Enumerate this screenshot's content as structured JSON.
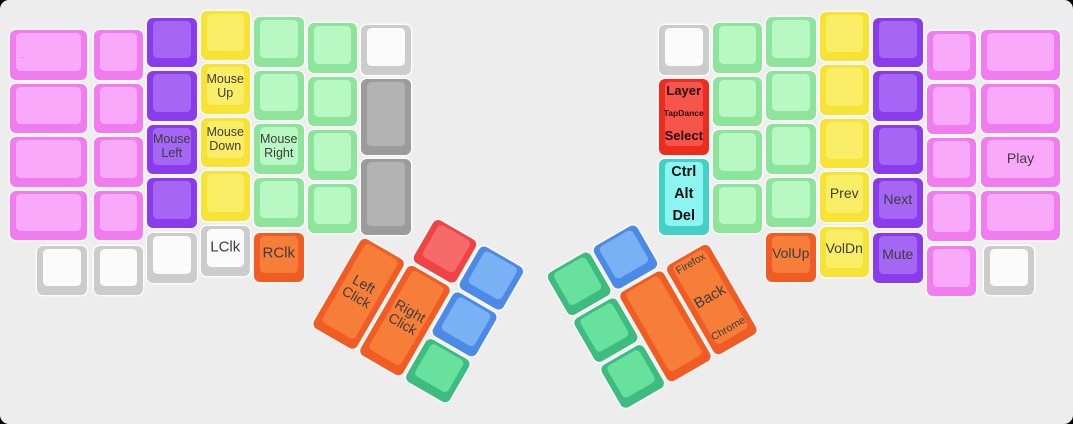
{
  "canvas": {
    "width": 1073,
    "height": 424,
    "background": "#ededed",
    "outside_background": "#000000",
    "key_outline": "rgba(255,255,255,0.75)"
  },
  "palette": {
    "pink": {
      "base": "#f07cf0",
      "top": "#f9a9f9"
    },
    "purple": {
      "base": "#8a3bee",
      "top": "#a466f3"
    },
    "yellow": {
      "base": "#f6e336",
      "top": "#faee67"
    },
    "green": {
      "base": "#8ce59b",
      "top": "#b8f8c2"
    },
    "white": {
      "base": "#cccccc",
      "top": "#fbfbfb"
    },
    "gray": {
      "base": "#9c9c9c",
      "top": "#b3b3b3"
    },
    "red": {
      "base": "#ee2c1e",
      "top": "#f5554a"
    },
    "cyan": {
      "base": "#43d0c6",
      "top": "#8cf5f2"
    },
    "orange": {
      "base": "#f15c25",
      "top": "#f67e39"
    },
    "blue": {
      "base": "#4b8be7",
      "top": "#79b1f4"
    },
    "emerald": {
      "base": "#3ebc7f",
      "top": "#68e19e"
    },
    "thumbred": {
      "base": "#f04343",
      "top": "#f66a6a"
    }
  },
  "groups": {
    "main": {
      "rotation_deg": 0,
      "origin_x": 0,
      "origin_y": 0
    },
    "thumb_left": {
      "rotation_deg": 30,
      "origin_x": 362,
      "origin_y": 234
    },
    "thumb_right": {
      "rotation_deg": -30,
      "origin_x": 708,
      "origin_y": 240
    }
  },
  "key_schema": [
    "group",
    "x",
    "y",
    "w",
    "h",
    "color",
    "name",
    "labels"
  ],
  "keys": [
    [
      "main",
      10,
      30,
      77,
      49.5,
      "pink",
      "key-left-c1-r1",
      [
        {
          "t": ".",
          "pos": "left",
          "size": 7,
          "color": "#555555"
        }
      ]
    ],
    [
      "main",
      10,
      83.5,
      77,
      49.5,
      "pink",
      "key-left-c1-r2"
    ],
    [
      "main",
      10,
      137,
      77,
      49.5,
      "pink",
      "key-left-c1-r3"
    ],
    [
      "main",
      10,
      190.5,
      77,
      49.5,
      "pink",
      "key-left-c1-r4"
    ],
    [
      "main",
      93.5,
      30,
      49.5,
      49.5,
      "pink",
      "key-left-c2-r1"
    ],
    [
      "main",
      93.5,
      83.5,
      49.5,
      49.5,
      "pink",
      "key-left-c2-r2"
    ],
    [
      "main",
      93.5,
      137,
      49.5,
      49.5,
      "pink",
      "key-left-c2-r3"
    ],
    [
      "main",
      93.5,
      190.5,
      49.5,
      49.5,
      "pink",
      "key-left-c2-r4"
    ],
    [
      "main",
      147,
      17.5,
      49.5,
      49.5,
      "purple",
      "key-left-c3-r1"
    ],
    [
      "main",
      147,
      71,
      49.5,
      49.5,
      "purple",
      "key-left-c3-r2"
    ],
    [
      "main",
      147,
      124.5,
      49.5,
      49.5,
      "purple",
      "key-mouse-left",
      [
        {
          "t": "Mouse Left",
          "pos": "center",
          "size": 12.5
        }
      ]
    ],
    [
      "main",
      147,
      178,
      49.5,
      49.5,
      "purple",
      "key-left-c3-r4"
    ],
    [
      "main",
      200.5,
      10.5,
      49.5,
      49.5,
      "yellow",
      "key-left-c4-r1"
    ],
    [
      "main",
      200.5,
      64,
      49.5,
      49.5,
      "yellow",
      "key-mouse-up",
      [
        {
          "t": "Mouse Up",
          "pos": "center",
          "size": 12.5
        }
      ]
    ],
    [
      "main",
      200.5,
      117.5,
      49.5,
      49.5,
      "yellow",
      "key-mouse-down",
      [
        {
          "t": "Mouse Down",
          "pos": "center",
          "size": 12.5
        }
      ]
    ],
    [
      "main",
      200.5,
      171,
      49.5,
      49.5,
      "yellow",
      "key-left-c4-r4"
    ],
    [
      "main",
      254,
      17,
      49.5,
      49.5,
      "green",
      "key-left-c5-r1"
    ],
    [
      "main",
      254,
      70.5,
      49.5,
      49.5,
      "green",
      "key-left-c5-r2"
    ],
    [
      "main",
      254,
      124,
      49.5,
      49.5,
      "green",
      "key-mouse-right",
      [
        {
          "t": "Mouse Right",
          "pos": "center",
          "size": 12.5
        }
      ]
    ],
    [
      "main",
      254,
      177.5,
      49.5,
      49.5,
      "green",
      "key-left-c5-r4"
    ],
    [
      "main",
      307.5,
      23,
      49.5,
      49.5,
      "green",
      "key-left-c6-r1"
    ],
    [
      "main",
      307.5,
      76.5,
      49.5,
      49.5,
      "green",
      "key-left-c6-r2"
    ],
    [
      "main",
      307.5,
      130,
      49.5,
      49.5,
      "green",
      "key-left-c6-r3"
    ],
    [
      "main",
      307.5,
      183.5,
      49.5,
      49.5,
      "green",
      "key-left-c6-r4"
    ],
    [
      "main",
      361,
      25,
      49.5,
      49.5,
      "white",
      "key-left-c7-r1"
    ],
    [
      "main",
      361,
      78.5,
      49.5,
      76.3,
      "gray",
      "key-left-c7-tall1"
    ],
    [
      "main",
      361,
      158.8,
      49.5,
      76.3,
      "gray",
      "key-left-c7-tall2"
    ],
    [
      "main",
      37,
      245.5,
      49.5,
      49.5,
      "white",
      "key-left-bottom-1"
    ],
    [
      "main",
      93.5,
      245.5,
      49.5,
      49.5,
      "white",
      "key-left-bottom-2"
    ],
    [
      "main",
      147,
      233,
      49.5,
      49.5,
      "white",
      "key-left-bottom-3"
    ],
    [
      "main",
      200.5,
      226,
      49.5,
      49.5,
      "white",
      "key-lclk",
      [
        {
          "t": "LClk",
          "pos": "center",
          "size": 15
        }
      ]
    ],
    [
      "main",
      254,
      232.5,
      49.5,
      49.5,
      "orange",
      "key-rclk",
      [
        {
          "t": "RClk",
          "pos": "center",
          "size": 15
        }
      ]
    ],
    [
      "thumb_left",
      55.5,
      -51.5,
      49.5,
      49.5,
      "thumbred",
      "key-lthumb-red"
    ],
    [
      "thumb_left",
      109,
      -51.5,
      49.5,
      49.5,
      "blue",
      "key-lthumb-blue1"
    ],
    [
      "thumb_left",
      2,
      2,
      49.5,
      103,
      "orange",
      "key-left-click",
      [
        {
          "t": "Left Click",
          "pos": "center",
          "size": 14
        }
      ]
    ],
    [
      "thumb_left",
      55.5,
      2,
      49.5,
      103,
      "orange",
      "key-right-click",
      [
        {
          "t": "Right Click",
          "pos": "center",
          "size": 14
        }
      ]
    ],
    [
      "thumb_left",
      109,
      2,
      49.5,
      49.5,
      "blue",
      "key-lthumb-blue2"
    ],
    [
      "thumb_left",
      109,
      55.5,
      49.5,
      49.5,
      "emerald",
      "key-lthumb-green"
    ],
    [
      "main",
      659,
      25,
      49.5,
      49.5,
      "white",
      "key-right-c1-r1"
    ],
    [
      "main",
      659,
      78.5,
      49.5,
      76.3,
      "red",
      "key-layer-tapdance-select",
      [
        {
          "t": "Layer",
          "pos": "top",
          "size": 13,
          "bold": true,
          "color": "#2d0b08"
        },
        {
          "t": "TapDance",
          "pos": "mid",
          "size": 8.5,
          "bold": true,
          "color": "#2d0b08"
        },
        {
          "t": "Select",
          "pos": "bottom",
          "size": 13,
          "bold": true,
          "color": "#2d0b08"
        }
      ]
    ],
    [
      "main",
      659,
      158.8,
      49.5,
      76.3,
      "cyan",
      "key-ctrl-alt-del",
      [
        {
          "t": "Ctrl",
          "pos": "top",
          "size": 14.5,
          "bold": true,
          "color": "#101010"
        },
        {
          "t": "Alt",
          "pos": "mid",
          "size": 14.5,
          "bold": true,
          "color": "#101010"
        },
        {
          "t": "Del",
          "pos": "bottom",
          "size": 14.5,
          "bold": true,
          "color": "#101010"
        }
      ]
    ],
    [
      "main",
      712.5,
      23,
      49.5,
      49.5,
      "green",
      "key-right-c2-r1"
    ],
    [
      "main",
      712.5,
      76.5,
      49.5,
      49.5,
      "green",
      "key-right-c2-r2"
    ],
    [
      "main",
      712.5,
      130,
      49.5,
      49.5,
      "green",
      "key-right-c2-r3"
    ],
    [
      "main",
      712.5,
      183.5,
      49.5,
      49.5,
      "green",
      "key-right-c2-r4"
    ],
    [
      "main",
      766,
      17,
      49.5,
      49.5,
      "green",
      "key-right-c3-r1"
    ],
    [
      "main",
      766,
      70.5,
      49.5,
      49.5,
      "green",
      "key-right-c3-r2"
    ],
    [
      "main",
      766,
      124,
      49.5,
      49.5,
      "green",
      "key-right-c3-r3"
    ],
    [
      "main",
      766,
      177.5,
      49.5,
      49.5,
      "green",
      "key-right-c3-r4"
    ],
    [
      "main",
      766,
      232.5,
      49.5,
      49.5,
      "orange",
      "key-volup",
      [
        {
          "t": "VolUp",
          "pos": "center",
          "size": 14
        }
      ]
    ],
    [
      "main",
      819.5,
      11.5,
      49.5,
      49.5,
      "yellow",
      "key-right-c4-r1"
    ],
    [
      "main",
      819.5,
      65,
      49.5,
      49.5,
      "yellow",
      "key-right-c4-r2"
    ],
    [
      "main",
      819.5,
      118.5,
      49.5,
      49.5,
      "yellow",
      "key-right-c4-r3"
    ],
    [
      "main",
      819.5,
      172,
      49.5,
      49.5,
      "yellow",
      "key-prev",
      [
        {
          "t": "Prev",
          "pos": "center",
          "size": 14
        }
      ]
    ],
    [
      "main",
      819.5,
      227,
      49.5,
      49.5,
      "yellow",
      "key-voldn",
      [
        {
          "t": "VolDn",
          "pos": "center",
          "size": 14
        }
      ]
    ],
    [
      "main",
      873,
      17.5,
      49.5,
      49.5,
      "purple",
      "key-right-c5-r1"
    ],
    [
      "main",
      873,
      71,
      49.5,
      49.5,
      "purple",
      "key-right-c5-r2"
    ],
    [
      "main",
      873,
      124.5,
      49.5,
      49.5,
      "purple",
      "key-right-c5-r3"
    ],
    [
      "main",
      873,
      178,
      49.5,
      49.5,
      "purple",
      "key-next",
      [
        {
          "t": "Next",
          "pos": "center",
          "size": 14
        }
      ]
    ],
    [
      "main",
      873,
      233,
      49.5,
      49.5,
      "purple",
      "key-mute",
      [
        {
          "t": "Mute",
          "pos": "center",
          "size": 14
        }
      ]
    ],
    [
      "main",
      926.5,
      30.5,
      49.5,
      49.5,
      "pink",
      "key-right-c6-r1"
    ],
    [
      "main",
      926.5,
      84,
      49.5,
      49.5,
      "pink",
      "key-right-c6-r2"
    ],
    [
      "main",
      926.5,
      137.5,
      49.5,
      49.5,
      "pink",
      "key-right-c6-r3"
    ],
    [
      "main",
      926.5,
      191,
      49.5,
      49.5,
      "pink",
      "key-right-c6-r4"
    ],
    [
      "main",
      926.5,
      246,
      49.5,
      49.5,
      "pink",
      "key-right-bottom-pink"
    ],
    [
      "main",
      981,
      30,
      79,
      49.5,
      "pink",
      "key-right-c7-r1"
    ],
    [
      "main",
      981,
      83.5,
      79,
      49.5,
      "pink",
      "key-right-c7-r2"
    ],
    [
      "main",
      981,
      137,
      79,
      49.5,
      "pink",
      "key-play",
      [
        {
          "t": "Play",
          "pos": "center",
          "size": 14
        }
      ]
    ],
    [
      "main",
      981,
      190.5,
      79,
      49.5,
      "pink",
      "key-right-c7-r4"
    ],
    [
      "main",
      984,
      245.5,
      49.5,
      49.5,
      "white",
      "key-right-bottom-white"
    ],
    [
      "thumb_right",
      -158.5,
      -51.5,
      49.5,
      49.5,
      "emerald",
      "key-rthumb-green1"
    ],
    [
      "thumb_right",
      -105,
      -51.5,
      49.5,
      49.5,
      "blue",
      "key-rthumb-blue"
    ],
    [
      "thumb_right",
      -158.5,
      2,
      49.5,
      49.5,
      "emerald",
      "key-rthumb-green2"
    ],
    [
      "thumb_right",
      -158.5,
      55.5,
      49.5,
      49.5,
      "emerald",
      "key-rthumb-green3"
    ],
    [
      "thumb_right",
      -105,
      2,
      49.5,
      103,
      "orange",
      "key-rthumb-blank"
    ],
    [
      "thumb_right",
      -51.5,
      2,
      49.5,
      103,
      "orange",
      "key-firefox-back-chrome",
      [
        {
          "t": "Firefox",
          "pos": "top",
          "size": 10.5
        },
        {
          "t": "Back",
          "pos": "mid",
          "size": 15
        },
        {
          "t": "Chrome",
          "pos": "bottom",
          "size": 10.5
        }
      ]
    ]
  ]
}
